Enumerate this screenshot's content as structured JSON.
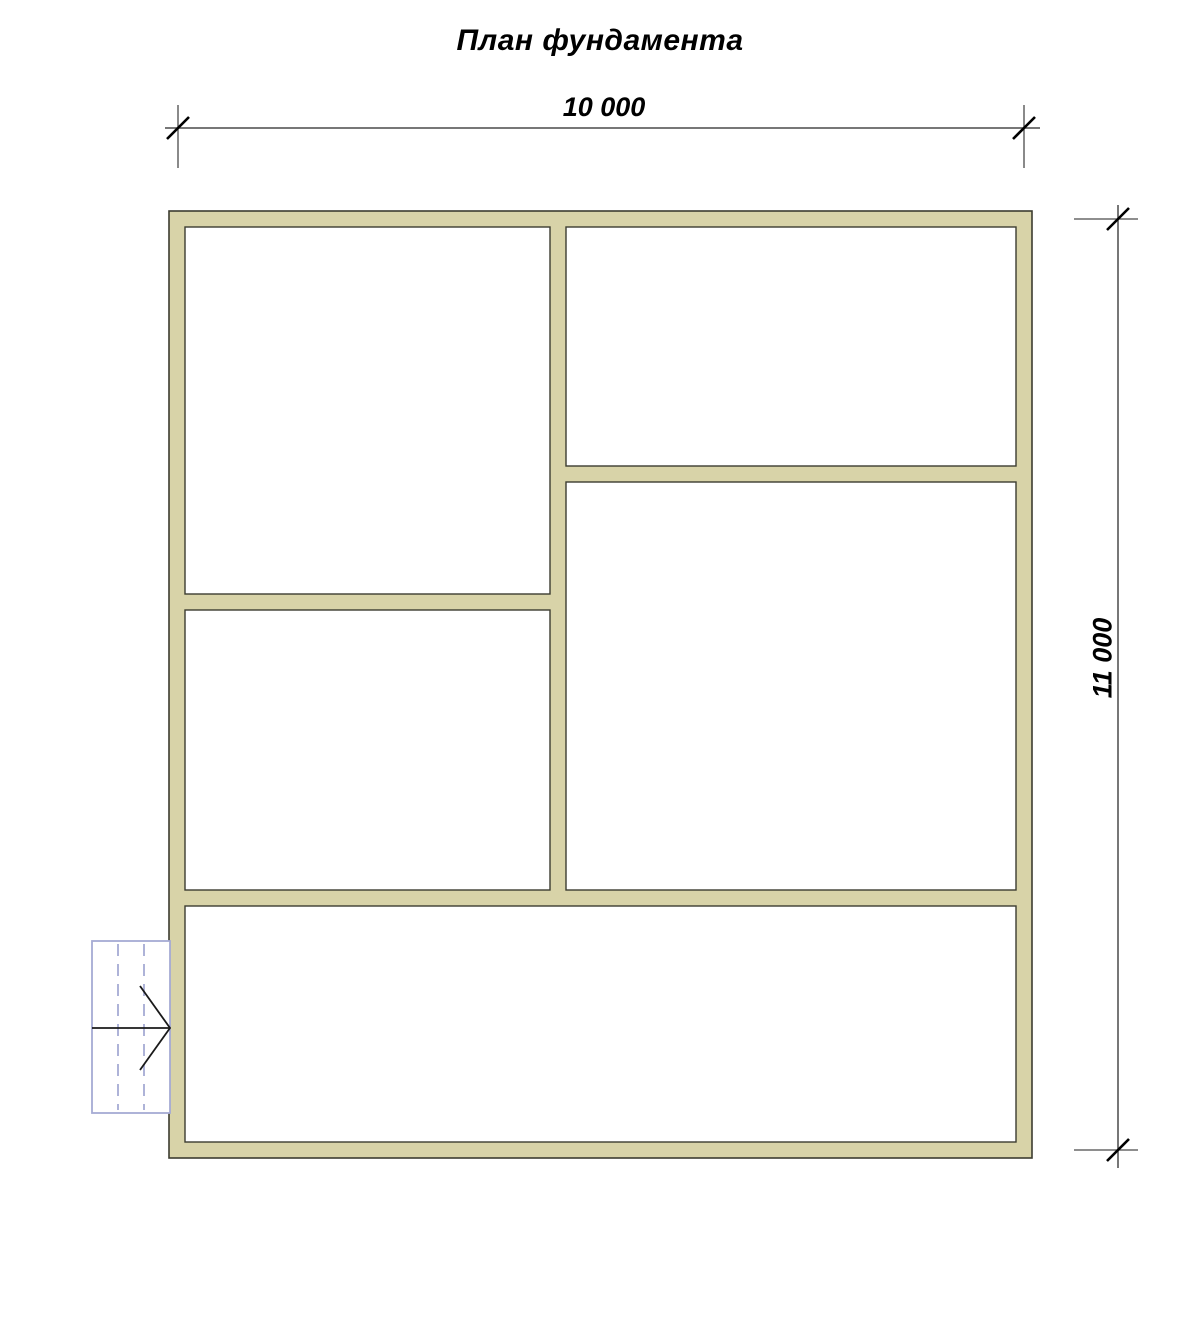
{
  "title": "План фундамента",
  "canvas": {
    "width": 1200,
    "height": 1328
  },
  "colors": {
    "background": "#ffffff",
    "wall_fill": "#d8d3a8",
    "wall_outline": "#3c3c30",
    "dimension_line": "#4a4a4a",
    "tick": "#000000",
    "text": "#000000",
    "stair_outline": "#a6abd4",
    "stair_arrow": "#1a1a1a"
  },
  "dimensions": {
    "horizontal": {
      "label": "10 000",
      "line": {
        "x1": 165,
        "y1": 128,
        "x2": 1040,
        "y2": 128
      },
      "extensions": [
        {
          "x1": 178,
          "y1": 105,
          "x2": 178,
          "y2": 168
        },
        {
          "x1": 1024,
          "y1": 105,
          "x2": 1024,
          "y2": 168
        }
      ],
      "ticks": [
        {
          "x": 178,
          "y": 128
        },
        {
          "x": 1024,
          "y": 128
        }
      ]
    },
    "vertical": {
      "label": "11 000",
      "line": {
        "x1": 1118,
        "y1": 205,
        "x2": 1118,
        "y2": 1168
      },
      "extensions": [
        {
          "x1": 1074,
          "y1": 219,
          "x2": 1138,
          "y2": 219
        },
        {
          "x1": 1074,
          "y1": 1150,
          "x2": 1138,
          "y2": 1150
        }
      ],
      "ticks": [
        {
          "x": 1118,
          "y": 219
        },
        {
          "x": 1118,
          "y": 1150
        }
      ]
    }
  },
  "building": {
    "outer": {
      "x": 169,
      "y": 211,
      "w": 863,
      "h": 947
    },
    "rooms": [
      {
        "name": "room-top-left",
        "x": 185,
        "y": 227,
        "w": 365,
        "h": 367
      },
      {
        "name": "room-top-right",
        "x": 566,
        "y": 227,
        "w": 450,
        "h": 239
      },
      {
        "name": "room-middle-right",
        "x": 566,
        "y": 482,
        "w": 450,
        "h": 408
      },
      {
        "name": "room-middle-left",
        "x": 185,
        "y": 610,
        "w": 365,
        "h": 280
      },
      {
        "name": "room-bottom",
        "x": 185,
        "y": 906,
        "w": 831,
        "h": 236
      }
    ]
  },
  "stairs": {
    "rect": {
      "x": 92,
      "y": 941,
      "w": 78,
      "h": 172
    },
    "dividers_x": [
      118,
      144
    ],
    "mid_line_y": 1028,
    "arrow": {
      "tip": {
        "x": 170,
        "y": 1028
      },
      "back_top": {
        "x": 140,
        "y": 986
      },
      "back_bottom": {
        "x": 140,
        "y": 1070
      }
    }
  }
}
